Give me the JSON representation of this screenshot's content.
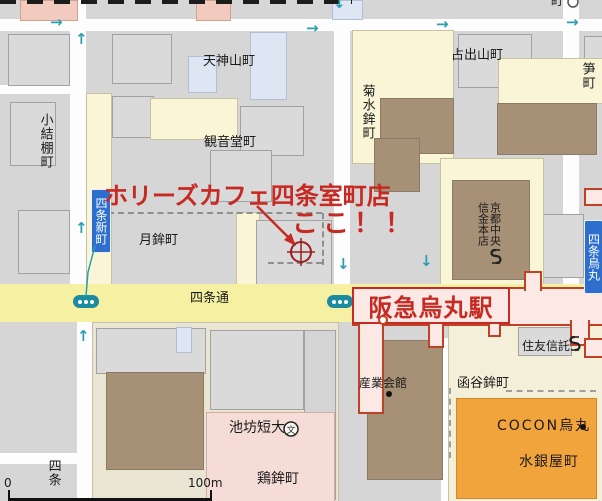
{
  "annotation": {
    "cafe_title": "ホリーズカフェ四条室町店",
    "here": "ここ！！"
  },
  "station": {
    "name": "阪急烏丸駅"
  },
  "signs": {
    "shijo_shinmachi": "四条新町",
    "shijo_karasuma": "四条烏丸"
  },
  "roads": {
    "shijo_dori": "四条通"
  },
  "areas": {
    "tenjinyamacho": "天神山町",
    "uradeyamacho": "占出山町",
    "kannondocho": "観音堂町",
    "komusubitanacho": "小結棚町",
    "tsukihokocho": "月鉾町",
    "kikusuihokocho": "菊水鉾町",
    "takecho": "笋町",
    "kankobokocho": "函谷鉾町",
    "suiginyacho": "水銀屋町",
    "niwatorihokocho": "鶏鉾町",
    "shijo_partial": "四条",
    "top_edge_partial": "町"
  },
  "pois": {
    "shinkin_col_right": "京都中央",
    "shinkin_col_left": "信金本店",
    "sumitomo_trust": "住友信託",
    "sangyo_kaikan": "産業会館",
    "cocon_karasuma": "COCON烏丸",
    "ikenobo_tandai": "池坊短大",
    "ikenobo_icon_char": "文"
  },
  "scale": {
    "zero": "0",
    "hundred_m": "100m"
  },
  "colors": {
    "accent_red": "#c62a22",
    "station_border": "#bf4126",
    "road_yellow": "#f6f0a3",
    "sign_blue": "#2e6fce",
    "teal": "#2b9fb0",
    "orange": "#f2a43c",
    "brown_building": "#a69076"
  }
}
